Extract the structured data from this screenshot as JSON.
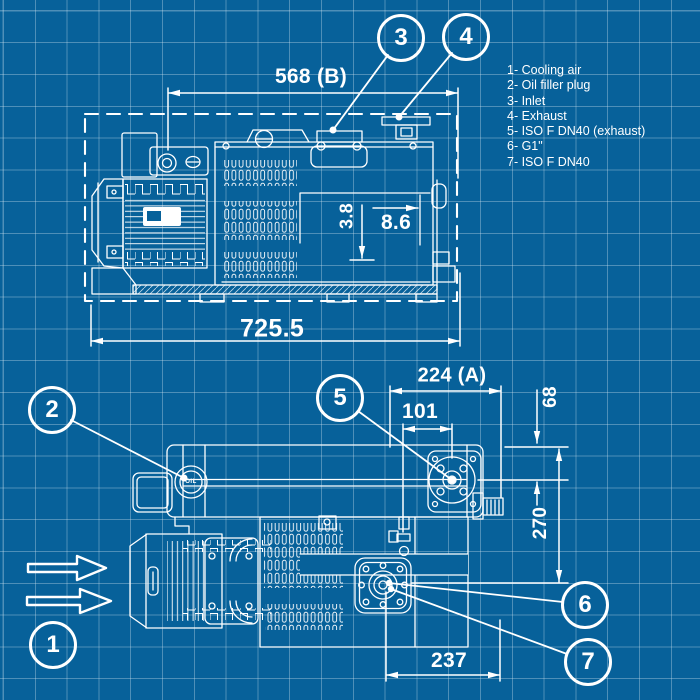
{
  "colors": {
    "background": "#07619a",
    "grid_line": "#4d87ae",
    "linework": "#ffffff"
  },
  "legend": {
    "items": [
      "1- Cooling air",
      "2- Oil filler plug",
      "3- Inlet",
      "4- Exhaust",
      "5- ISO F DN40 (exhaust)",
      "6- G1\"",
      "7- ISO F DN40"
    ]
  },
  "callouts": {
    "c1": "1",
    "c2": "2",
    "c3": "3",
    "c4": "4",
    "c5": "5",
    "c6": "6",
    "c7": "7"
  },
  "side_view": {
    "dims": {
      "b": "568 (B)",
      "total_length": "725.5",
      "oil_min": "3.8",
      "oil_max": "8.6"
    }
  },
  "plan_view": {
    "dims": {
      "a": "224 (A)",
      "d101": "101",
      "d68": "68",
      "d270": "270",
      "d237": "237"
    },
    "oil_plug": "OIL"
  }
}
